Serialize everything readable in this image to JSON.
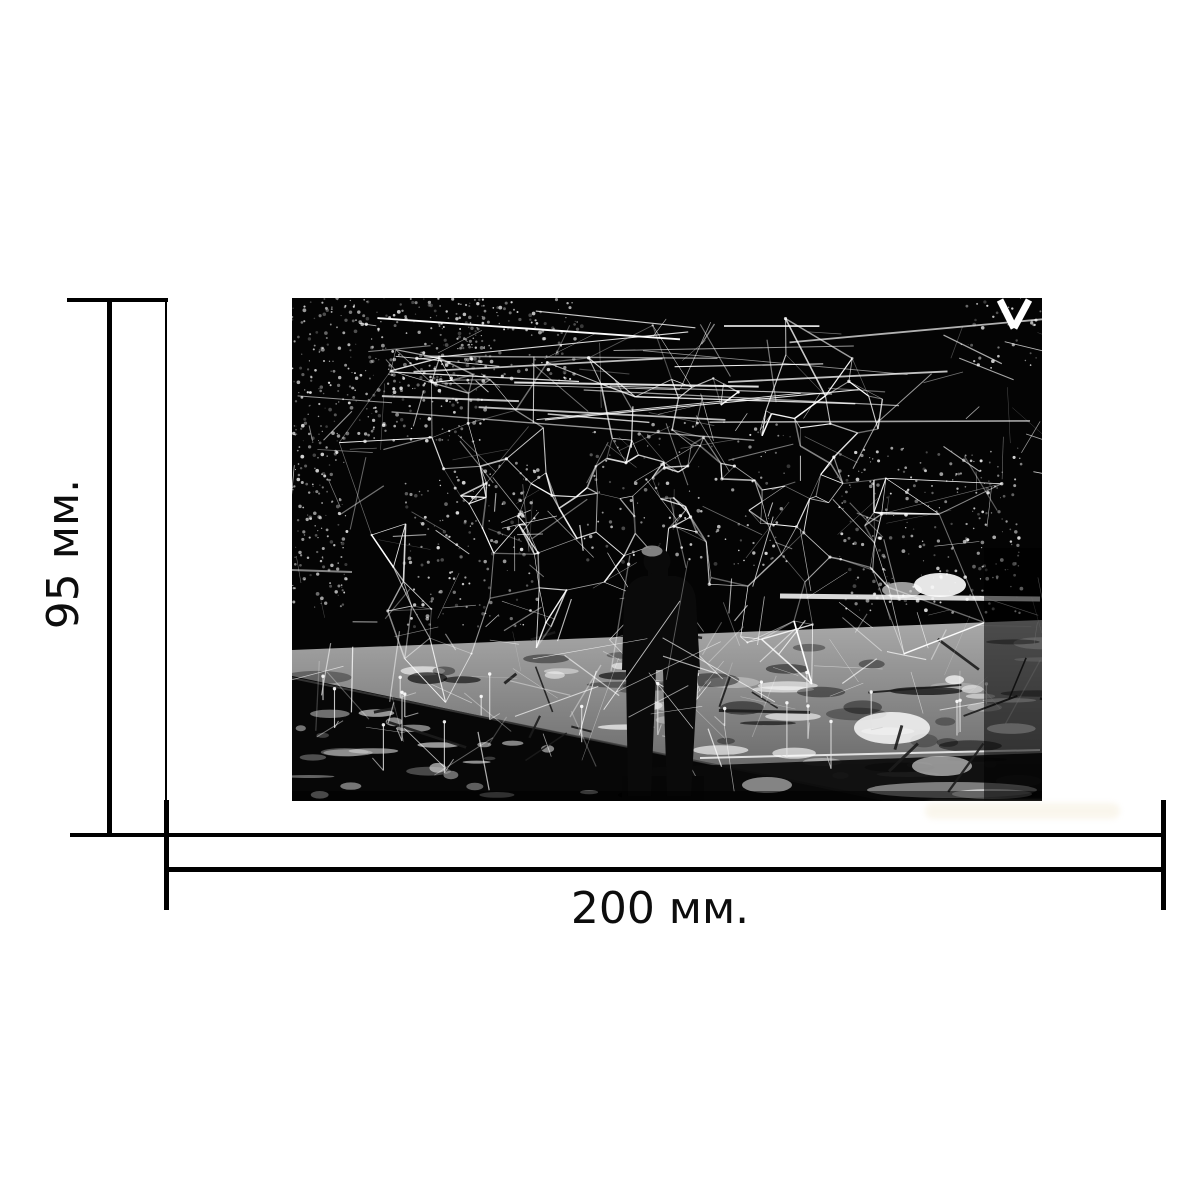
{
  "dimensions": {
    "height_label": "95 мм.",
    "width_label": "200 мм.",
    "line_color": "#000000",
    "label_color": "#0d0d0d",
    "background": "#ffffff"
  },
  "photo": {
    "description": "Black-and-white photograph: a person seen from behind stands on a sunlit concrete plinth inside a huge chaotic sculpture of thin welded metal rods, dark trees with dappled bright foliage behind, lit grass in the lower-left foreground",
    "width": 750,
    "height": 503,
    "colors": {
      "bg": "#040404",
      "rod": "#ffffff",
      "platform_top": "#a9a9a9",
      "platform_bottom": "#5e5e5e",
      "grass": "#070707",
      "person": "#0a0a0a"
    },
    "bright": {
      "ellipses": [
        [
          648,
          287,
          26,
          12,
          0.9
        ],
        [
          610,
          292,
          20,
          8,
          0.6
        ],
        [
          600,
          430,
          38,
          16,
          0.8
        ],
        [
          650,
          468,
          30,
          10,
          0.55
        ],
        [
          660,
          492,
          85,
          8,
          0.45
        ],
        [
          700,
          496,
          40,
          5,
          0.6
        ],
        [
          475,
          487,
          25,
          8,
          0.5
        ]
      ],
      "streaks": [
        [
          488,
          298,
          748,
          301,
          5,
          0.85
        ],
        [
          0,
          272,
          60,
          274,
          2,
          0.5
        ],
        [
          708,
          2,
          722,
          30,
          7,
          1
        ],
        [
          737,
          2,
          722,
          30,
          7,
          1
        ],
        [
          408,
          460,
          748,
          452,
          2,
          0.8
        ]
      ]
    },
    "person": {
      "head": [
        365,
        263,
        13.5
      ],
      "cap": [
        360,
        253,
        10.5,
        5.5,
        "#8d8d8d"
      ],
      "neck": [
        356,
        268,
        20,
        16
      ],
      "torso": "M332,302 Q334,282 352,278 L384,278 Q402,282 404,302 L408,372 L330,372 Z",
      "legs": "M334,372 L364,372 L359,498 L336,498 Z M371,372 L406,372 L399,498 L375,498 Z",
      "shadow": [
        368,
        497,
        42,
        6
      ]
    },
    "gen": {
      "seed": 11,
      "speckle_clusters": [
        {
          "x": 0,
          "y": 0,
          "w": 195,
          "h": 145,
          "n": 380
        },
        {
          "x": 0,
          "y": 145,
          "w": 55,
          "h": 165,
          "n": 130
        },
        {
          "x": 125,
          "y": 0,
          "w": 165,
          "h": 85,
          "n": 150
        },
        {
          "x": 112,
          "y": 165,
          "w": 135,
          "h": 165,
          "n": 170
        },
        {
          "x": 545,
          "y": 150,
          "w": 185,
          "h": 165,
          "n": 260
        },
        {
          "x": 668,
          "y": 0,
          "w": 82,
          "h": 70,
          "n": 40
        },
        {
          "x": 290,
          "y": 120,
          "w": 210,
          "h": 150,
          "n": 130
        },
        {
          "x": 640,
          "y": 478,
          "w": 110,
          "h": 24,
          "n": 60
        }
      ],
      "web": {
        "nodes": 170,
        "region": [
          10,
          5,
          730,
          420
        ],
        "links": 3,
        "extra_top": 26,
        "extra_scatter": 200
      },
      "feet": 26,
      "platform_dapples": 46,
      "platform_shadows": 34,
      "grass_dapples": 30,
      "dark_rods": 20,
      "front_rods": 16
    }
  }
}
